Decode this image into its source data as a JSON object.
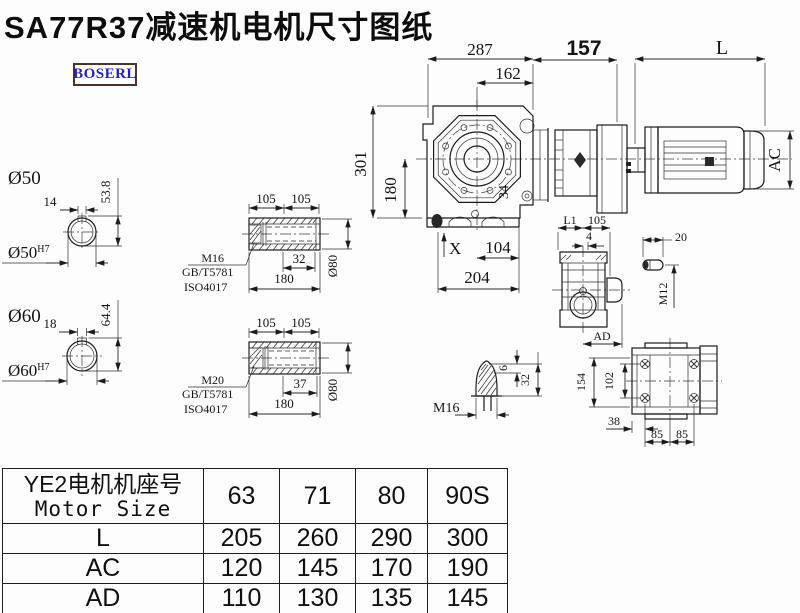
{
  "title": "SA77R37减速机电机尺寸图纸",
  "logo": "BOSERL",
  "colors": {
    "line": "#1c1c1c",
    "logo_text": "#2222c0",
    "logo_border": "#4a3428"
  },
  "main": {
    "d287": "287",
    "d162": "162",
    "d157": "157",
    "dL": "L",
    "dAC": "AC",
    "d301": "301",
    "d180": "180",
    "d104": "104",
    "d204": "204",
    "d34": "34",
    "dX": "X"
  },
  "side": {
    "dL1": "L1",
    "d105": "105",
    "d4": "4",
    "dAD": "AD",
    "d20": "20",
    "dM12": "M12"
  },
  "rear": {
    "d154": "154",
    "d102": "102",
    "d38": "38",
    "d85a": "85",
    "d85b": "85"
  },
  "shaft50": {
    "label": "Ø50",
    "d14": "14",
    "d538": "53.8",
    "bore": "Ø50",
    "bore_tol": "H7"
  },
  "shaft60": {
    "label": "Ø60",
    "d18": "18",
    "d644": "64.4",
    "bore": "Ø60",
    "bore_tol": "H7"
  },
  "hollow1": {
    "d105a": "105",
    "d105b": "105",
    "d32": "32",
    "d180": "180",
    "d80": "Ø80",
    "bolt": "M16",
    "std1": "GB/T5781",
    "std2": "ISO4017"
  },
  "hollow2": {
    "d105a": "105",
    "d105b": "105",
    "d37": "37",
    "d180": "180",
    "d80": "Ø80",
    "bolt": "M20",
    "std1": "GB/T5781",
    "std2": "ISO4017"
  },
  "plug": {
    "thread": "M16",
    "d6": "6",
    "d32": "32"
  },
  "table": {
    "header_cn": "YE2电机机座号",
    "header_en": "Motor Size",
    "sizes": [
      "63",
      "71",
      "80",
      "90S"
    ],
    "rows": [
      {
        "label": "L",
        "values": [
          "205",
          "260",
          "290",
          "300"
        ]
      },
      {
        "label": "AC",
        "values": [
          "120",
          "145",
          "170",
          "190"
        ]
      },
      {
        "label": "AD",
        "values": [
          "110",
          "130",
          "135",
          "145"
        ]
      }
    ]
  }
}
